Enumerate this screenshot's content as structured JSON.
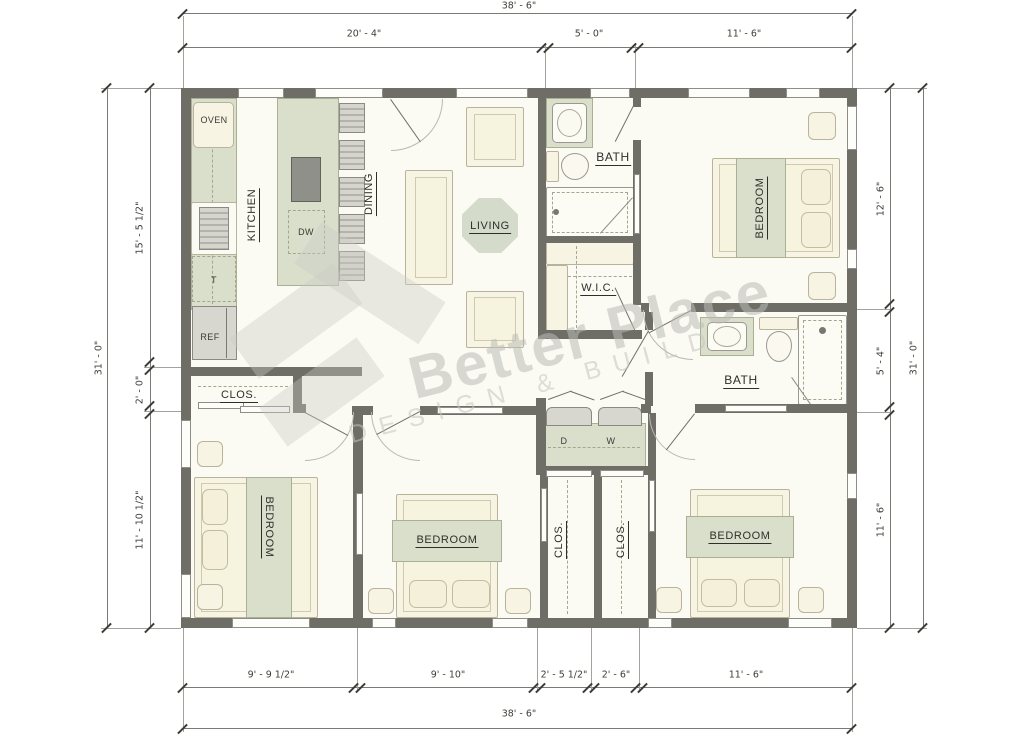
{
  "watermark": {
    "brand": "Better Place",
    "tagline": "DESIGN & BUILD"
  },
  "dimensions": {
    "top": {
      "overall": "38' - 6\"",
      "segments": [
        "20' - 4\"",
        "5' - 0\"",
        "11' - 6\""
      ]
    },
    "bottom": {
      "overall": "38' - 6\"",
      "segments": [
        "9' - 9 1/2\"",
        "9' - 10\"",
        "2' - 5 1/2\"",
        "2' - 6\"",
        "11' - 6\""
      ]
    },
    "left": {
      "overall": "31' - 0\"",
      "segments": [
        "15' - 5 1/2\"",
        "2' - 0\"",
        "11' - 10 1/2\""
      ]
    },
    "right": {
      "overall": "31' - 0\"",
      "segments": [
        "12' - 6\"",
        "5' - 4\"",
        "11' - 6\""
      ]
    }
  },
  "rooms": {
    "kitchen": "KITCHEN",
    "dining": "DINING",
    "living": "LIVING",
    "bath_top": "BATH",
    "bath_right": "BATH",
    "wic": "W.I.C.",
    "closet_hall": "CLOS.",
    "closet_left": "CLOS.",
    "closet_right": "CLOS.",
    "bedroom_top": "BEDROOM",
    "bedroom_bottom_left": "BEDROOM",
    "bedroom_bottom_middle": "BEDROOM",
    "bedroom_bottom_right": "BEDROOM"
  },
  "fixtures": {
    "oven": "OVEN",
    "dishwasher": "DW",
    "refrigerator": "REF",
    "trash": "T",
    "dryer": "D",
    "washer": "W"
  },
  "colors": {
    "wall": "#6e6e66",
    "floor": "#fbfaf3",
    "counter_green": "#d9dfcb",
    "furniture_cream": "#f7f4e3",
    "appliance_gray": "#d7d6cf",
    "dimension_text": "#3e3e38"
  }
}
